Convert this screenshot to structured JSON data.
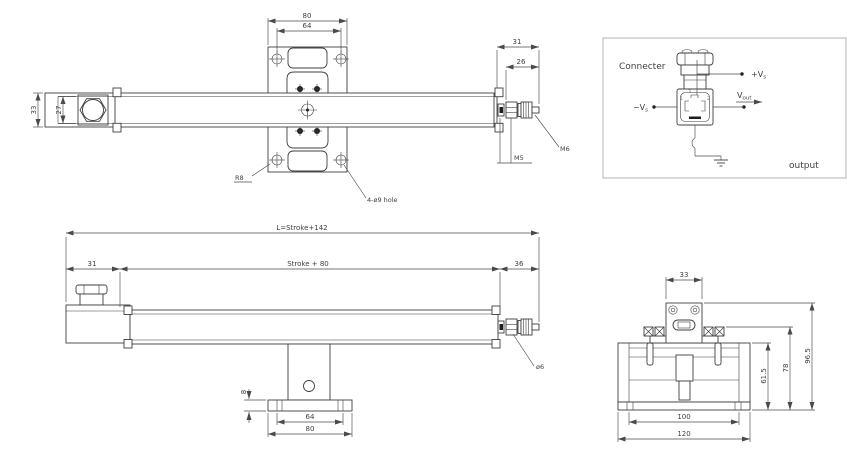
{
  "top_view": {
    "dim_80": "80",
    "dim_64": "64",
    "dim_33": "33",
    "dim_27": "27",
    "dim_31": "31",
    "dim_26": "26",
    "label_m6": "M6",
    "label_m5": "M5",
    "label_r8": "R8",
    "label_holes": "4-ø9 hole"
  },
  "connector_diagram": {
    "title": "Connecter",
    "plus_vs": {
      "base": "+V",
      "sub": "s"
    },
    "minus_vs": {
      "base": "−V",
      "sub": "s"
    },
    "vout": {
      "base": "V",
      "sub": "out"
    },
    "output_label": "output",
    "pin_1": "1",
    "pin_2": "2",
    "pin_3": "3"
  },
  "side_view": {
    "dim_overall": "L=Stroke+142",
    "dim_left": "31",
    "dim_stroke": "Stroke + 80",
    "dim_right": "36",
    "dim_plate_thickness": "8",
    "dim_64": "64",
    "dim_80": "80",
    "label_rod_dia": "ø6"
  },
  "end_view": {
    "dim_33": "33",
    "dim_61_5": "61.5",
    "dim_78": "78",
    "dim_96_5": "96.5",
    "dim_100": "100",
    "dim_120": "120"
  },
  "colors": {
    "line": "#3f3f3f",
    "dimension": "#4a4a4a",
    "diagram_border": "#b3b3b3",
    "background": "#ffffff"
  }
}
